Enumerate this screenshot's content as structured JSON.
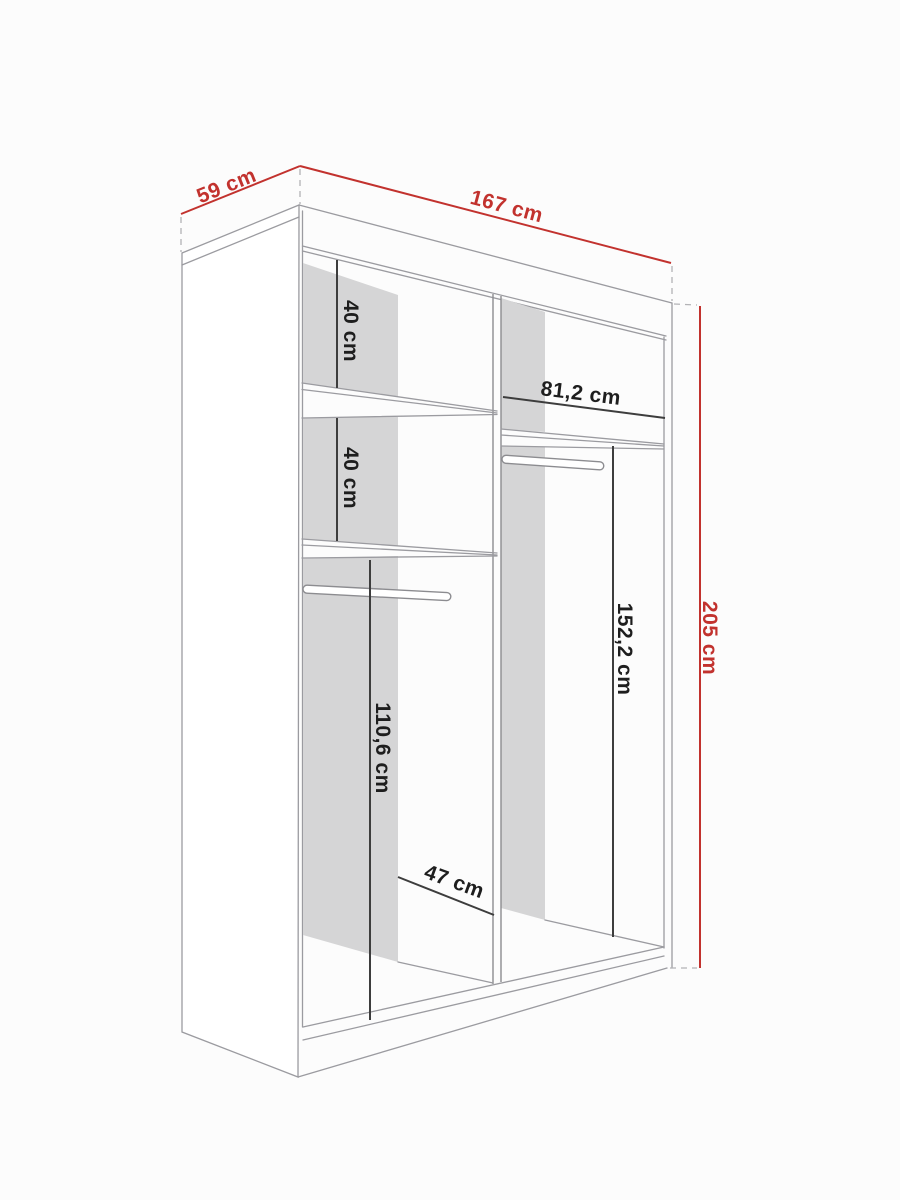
{
  "diagram": {
    "type": "wardrobe-dimension-drawing",
    "description": "Perspective line drawing of a two-compartment sliding wardrobe carcass with red overall dimensions and black internal dimensions",
    "colors": {
      "background": "#fcfcfc",
      "structure_line": "#9b9ba0",
      "back_panel_shadow": "#d5d5d6",
      "dimension_red": "#c2322e",
      "dimension_black": "#1e1e1e"
    },
    "dimensions": {
      "depth": {
        "label": "59 cm",
        "value_cm": 59
      },
      "width": {
        "label": "167 cm",
        "value_cm": 167
      },
      "height": {
        "label": "205 cm",
        "value_cm": 205
      },
      "left_top_section": {
        "label": "40 cm",
        "value_cm": 40
      },
      "left_second_section": {
        "label": "40 cm",
        "value_cm": 40
      },
      "right_inner_width": {
        "label": "81,2 cm",
        "value_cm": 81.2
      },
      "right_hanging_height": {
        "label": "152,2 cm",
        "value_cm": 152.2
      },
      "left_hanging_height": {
        "label": "110,6 cm",
        "value_cm": 110.6
      },
      "left_inner_width": {
        "label": "47 cm",
        "value_cm": 47
      }
    }
  }
}
